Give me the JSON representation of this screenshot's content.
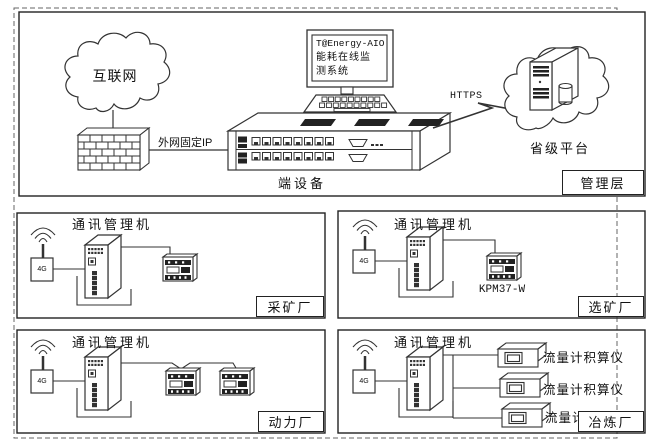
{
  "management": {
    "layer_label": "管理层",
    "internet_cloud": "互联网",
    "wan_ip_label": "外网固定IP",
    "terminal_device_label": "端设备",
    "monitor": {
      "line1": "T@Energy-AIO",
      "line2": "能耗在线监",
      "line3": "测系统"
    },
    "link_protocol": "HTTPS",
    "provincial_platform": "省级平台"
  },
  "plants": [
    {
      "name": "采矿厂",
      "gateway": "通讯管理机",
      "module": "4G"
    },
    {
      "name": "选矿厂",
      "gateway": "通讯管理机",
      "module": "4G",
      "meter_model": "KPM37-W"
    },
    {
      "name": "动力厂",
      "gateway": "通讯管理机",
      "module": "4G"
    },
    {
      "name": "冶炼厂",
      "gateway": "通讯管理机",
      "module": "4G",
      "devices": [
        "流量计积算仪",
        "流量计积算仪",
        "流量计积算仪"
      ]
    }
  ],
  "colors": {
    "line": "#333333",
    "text": "#111111",
    "background": "#ffffff"
  }
}
